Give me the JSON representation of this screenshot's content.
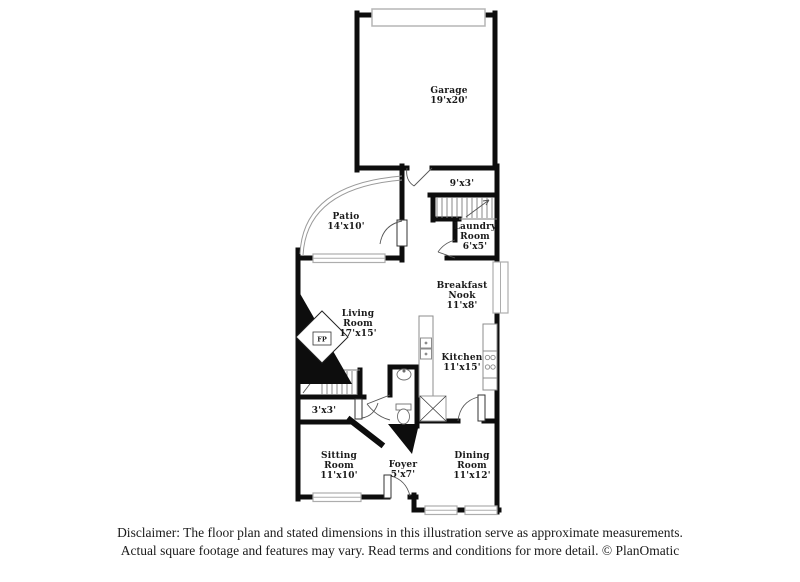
{
  "plan": {
    "rooms": {
      "garage": {
        "name": "Garage",
        "dims": "19'x20'"
      },
      "patio": {
        "name": "Patio",
        "dims": "14'x10'"
      },
      "upper_hall": {
        "dims": "9'x3'"
      },
      "laundry": {
        "line1": "Laundry",
        "line2": "Room",
        "dims": "6'x5'"
      },
      "breakfast_nook": {
        "line1": "Breakfast",
        "line2": "Nook",
        "dims": "11'x8'"
      },
      "living_room": {
        "line1": "Living",
        "line2": "Room",
        "dims": "17'x15'"
      },
      "kitchen": {
        "name": "Kitchen",
        "dims": "11'x15'"
      },
      "under_stair_closet": {
        "dims": "3'x3'"
      },
      "sitting_room": {
        "line1": "Sitting",
        "line2": "Room",
        "dims": "11'x10'"
      },
      "foyer": {
        "name": "Foyer",
        "dims": "5'x7'"
      },
      "dining_room": {
        "line1": "Dining",
        "line2": "Room",
        "dims": "11'x12'"
      }
    },
    "fireplace_label": "FP"
  },
  "footer": {
    "line1": "Disclaimer: The floor plan and stated dimensions in this illustration serve as approximate measurements.",
    "line2": "Actual square footage and features may vary. Read terms and conditions for more detail. © PlanOmatic"
  },
  "colors": {
    "wall": "#0d0d0d",
    "fixture_gray": "#8c8c8c",
    "window_gray": "#adadad",
    "text": "#1a1a1a"
  }
}
